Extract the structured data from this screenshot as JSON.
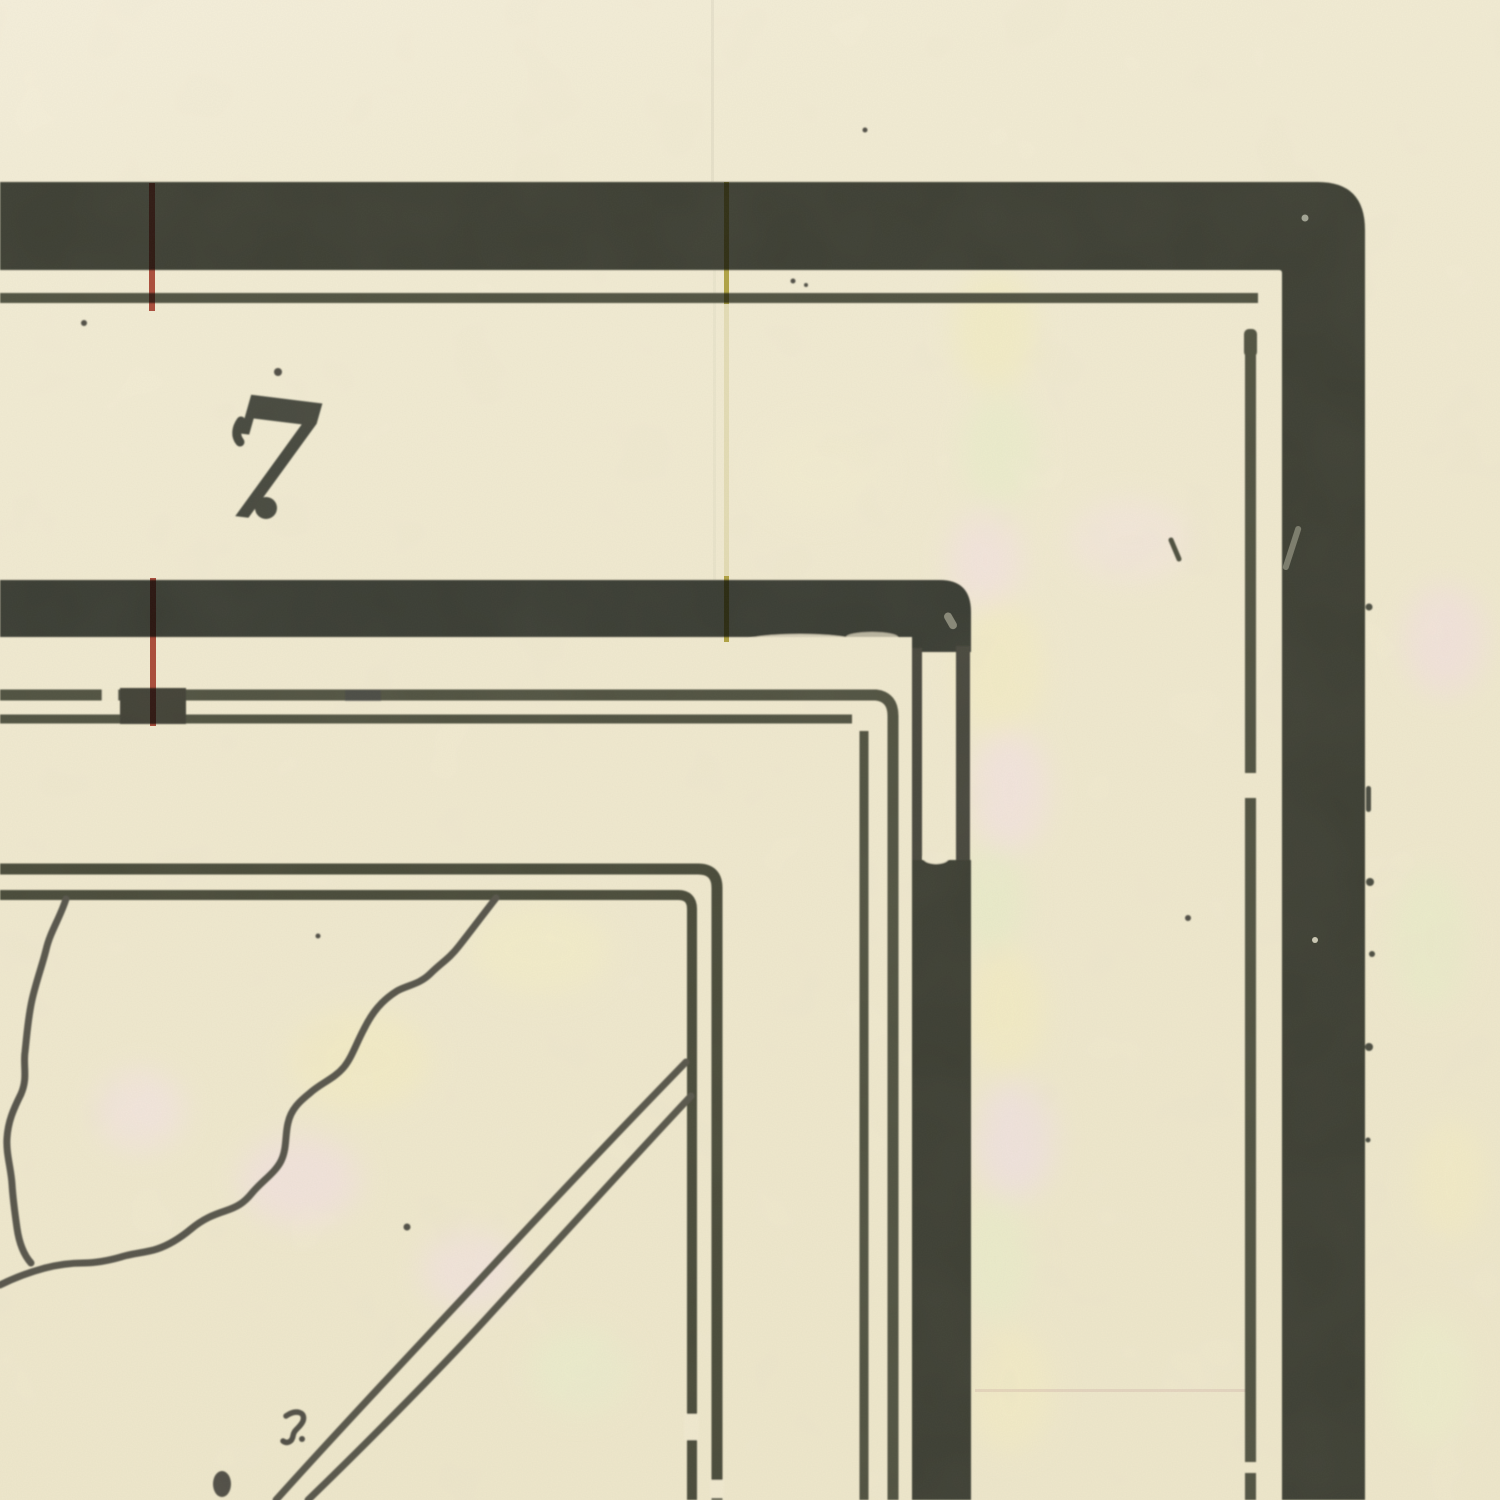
{
  "artifact": {
    "description": "Scanned corner detail of an antique map index sheet",
    "sheet_label": "7"
  },
  "colors": {
    "paper": "#f2ebd1",
    "paper_light": "#f6f0dc",
    "band_ink": "#3b3d33",
    "line_ink": "#50513f",
    "numeral_ink": "#45473c",
    "red_register_line": "#b0463a",
    "yellow_register_line": "#b3a83c"
  }
}
